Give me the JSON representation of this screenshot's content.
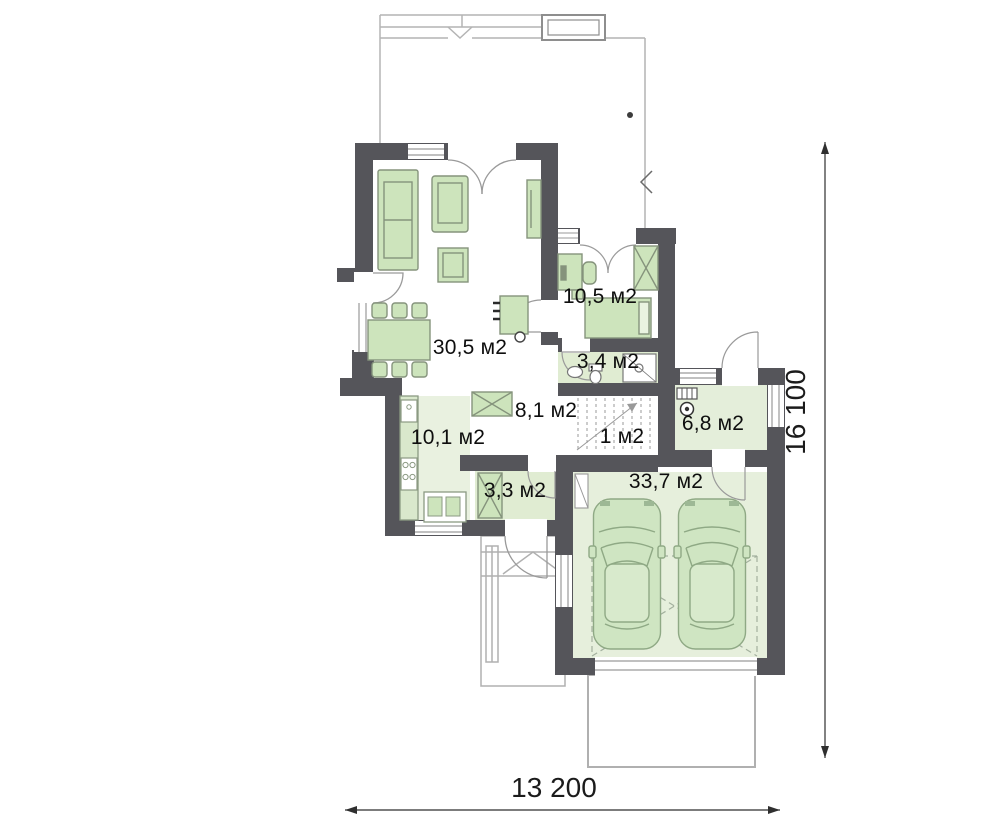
{
  "plan": {
    "title": "House ground floor plan",
    "rooms": [
      {
        "key": "living-dining",
        "label": "30,5 м2"
      },
      {
        "key": "bedroom-office",
        "label": "10,5 м2"
      },
      {
        "key": "bathroom",
        "label": "3,4 м2"
      },
      {
        "key": "hall",
        "label": "8,1 м2"
      },
      {
        "key": "stairs",
        "label": "1 м2"
      },
      {
        "key": "boiler-room",
        "label": "6,8 м2"
      },
      {
        "key": "kitchen",
        "label": "10,1 м2"
      },
      {
        "key": "vestibule",
        "label": "3,3 м2"
      },
      {
        "key": "garage",
        "label": "33,7 м2"
      }
    ],
    "dimensions": {
      "width_label": "13 200",
      "depth_label": "16 100"
    },
    "colors": {
      "wall": "#55555a",
      "room_fill": "#e4eeda",
      "garage_fill": "#e6efdc",
      "furniture_fill": "#cde4bc",
      "furniture_stroke": "#85937c",
      "car_fill": "#cfe5c2",
      "car_stroke": "#8fa985",
      "thin_line": "#9a9a9a",
      "terrace_line": "#b4b4b4",
      "dimension_line": "#2f2f2f"
    }
  }
}
